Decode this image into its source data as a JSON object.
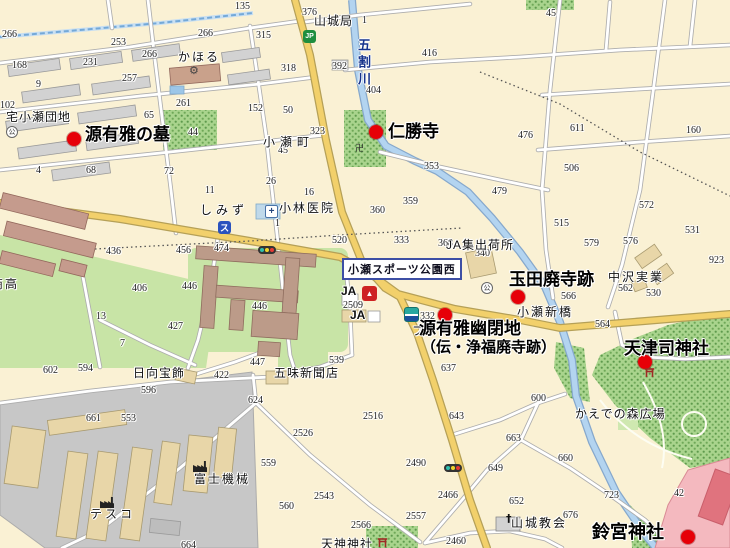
{
  "map": {
    "sign": {
      "text": "小瀬スポーツ公園西"
    },
    "river": {
      "name": "五割川"
    },
    "colors": {
      "marker_red": "#E60008",
      "major_road": "#F2D06B",
      "river_blue": "#B3D4F0",
      "forest_green": "#A9D48D",
      "field_green": "#C8E4A6",
      "industrial_gray": "#C7C7C7"
    },
    "pois": [
      {
        "t": "源有雅の墓",
        "x": 85,
        "y": 126,
        "size": 17,
        "mx": 74,
        "my": 139
      },
      {
        "t": "仁勝寺",
        "x": 388,
        "y": 123,
        "size": 17,
        "mx": 376,
        "my": 132
      },
      {
        "t": "玉田廃寺跡",
        "x": 509,
        "y": 271,
        "size": 17,
        "mx": 518,
        "my": 297
      },
      {
        "t": "源有雅幽閉地",
        "x": 419,
        "y": 320,
        "size": 17,
        "mx": 445,
        "my": 315,
        "line2": {
          "t": "（伝・浄福廃寺跡）",
          "x": 421,
          "y": 340,
          "size": 15
        }
      },
      {
        "t": "天津司神社",
        "x": 624,
        "y": 340,
        "size": 17,
        "mx": 645,
        "my": 362
      },
      {
        "t": "鈴宮神社",
        "x": 592,
        "y": 523,
        "size": 18,
        "mx": 688,
        "my": 537
      }
    ],
    "places": [
      {
        "x": 178,
        "y": 51,
        "t": "かほる",
        "ls": 2
      },
      {
        "x": 6,
        "y": 111,
        "t": "宅小瀬団地",
        "ls": 1
      },
      {
        "x": 314,
        "y": 15,
        "t": "山城局",
        "ls": 1
      },
      {
        "x": 263,
        "y": 136,
        "t": "小瀬町",
        "ls": 5
      },
      {
        "x": 200,
        "y": 204,
        "t": "しみず",
        "ls": 4
      },
      {
        "x": 279,
        "y": 202,
        "t": "小林医院",
        "ls": 2
      },
      {
        "x": 446,
        "y": 239,
        "t": "JA集出荷所",
        "ls": 1
      },
      {
        "x": 608,
        "y": 271,
        "t": "中沢実業",
        "ls": 2
      },
      {
        "x": 517,
        "y": 306,
        "t": "小瀬新橋",
        "ls": 2
      },
      {
        "x": 341,
        "y": 285,
        "t": "JA",
        "b": 1
      },
      {
        "x": 350,
        "y": 309,
        "t": "JA",
        "b": 1
      },
      {
        "x": 133,
        "y": 367,
        "t": "日向宝飾",
        "ls": 1
      },
      {
        "x": 274,
        "y": 367,
        "t": "五味新聞店",
        "ls": 1
      },
      {
        "x": 194,
        "y": 473,
        "t": "富士機械",
        "ls": 2
      },
      {
        "x": 90,
        "y": 508,
        "t": "テスコ",
        "ls": 3
      },
      {
        "x": 511,
        "y": 517,
        "t": "山城教会",
        "ls": 2
      },
      {
        "x": 575,
        "y": 408,
        "t": "かえでの森広場",
        "ls": 1
      },
      {
        "x": 321,
        "y": 538,
        "t": "天神神社",
        "ls": 1
      },
      {
        "x": -9,
        "y": 278,
        "t": "商高",
        "ls": 2
      },
      {
        "x": 412,
        "y": 325,
        "t": "フ"
      }
    ],
    "numbers": [
      {
        "x": 235,
        "y": 2,
        "t": "135"
      },
      {
        "x": 2,
        "y": 30,
        "t": "266"
      },
      {
        "x": 111,
        "y": 38,
        "t": "253"
      },
      {
        "x": 142,
        "y": 50,
        "t": "266"
      },
      {
        "x": 198,
        "y": 29,
        "t": "266"
      },
      {
        "x": 83,
        "y": 58,
        "t": "231"
      },
      {
        "x": 122,
        "y": 74,
        "t": "257"
      },
      {
        "x": 12,
        "y": 61,
        "t": "168"
      },
      {
        "x": 36,
        "y": 80,
        "t": "9"
      },
      {
        "x": 0,
        "y": 101,
        "t": "102"
      },
      {
        "x": 176,
        "y": 99,
        "t": "261"
      },
      {
        "x": 144,
        "y": 111,
        "t": "65"
      },
      {
        "x": 188,
        "y": 128,
        "t": "44"
      },
      {
        "x": 86,
        "y": 166,
        "t": "68"
      },
      {
        "x": 164,
        "y": 167,
        "t": "72"
      },
      {
        "x": 36,
        "y": 166,
        "t": "4"
      },
      {
        "x": 205,
        "y": 186,
        "t": "11"
      },
      {
        "x": 256,
        "y": 31,
        "t": "315"
      },
      {
        "x": 281,
        "y": 64,
        "t": "318"
      },
      {
        "x": 332,
        "y": 62,
        "t": "392"
      },
      {
        "x": 422,
        "y": 49,
        "t": "416"
      },
      {
        "x": 366,
        "y": 86,
        "t": "404"
      },
      {
        "x": 248,
        "y": 104,
        "t": "152"
      },
      {
        "x": 283,
        "y": 106,
        "t": "50"
      },
      {
        "x": 310,
        "y": 127,
        "t": "323"
      },
      {
        "x": 278,
        "y": 146,
        "t": "45"
      },
      {
        "x": 266,
        "y": 177,
        "t": "26"
      },
      {
        "x": 424,
        "y": 162,
        "t": "353"
      },
      {
        "x": 304,
        "y": 188,
        "t": "16"
      },
      {
        "x": 302,
        "y": 8,
        "t": "376"
      },
      {
        "x": 362,
        "y": 16,
        "t": "1"
      },
      {
        "x": 546,
        "y": 9,
        "t": "45"
      },
      {
        "x": 518,
        "y": 131,
        "t": "476"
      },
      {
        "x": 570,
        "y": 124,
        "t": "611"
      },
      {
        "x": 686,
        "y": 126,
        "t": "160"
      },
      {
        "x": 564,
        "y": 164,
        "t": "506"
      },
      {
        "x": 492,
        "y": 187,
        "t": "479"
      },
      {
        "x": 106,
        "y": 247,
        "t": "436"
      },
      {
        "x": 176,
        "y": 246,
        "t": "456"
      },
      {
        "x": 214,
        "y": 244,
        "t": "474"
      },
      {
        "x": 132,
        "y": 284,
        "t": "406"
      },
      {
        "x": 182,
        "y": 282,
        "t": "446"
      },
      {
        "x": 96,
        "y": 312,
        "t": "13"
      },
      {
        "x": 168,
        "y": 322,
        "t": "427"
      },
      {
        "x": 120,
        "y": 339,
        "t": "7"
      },
      {
        "x": 403,
        "y": 197,
        "t": "359"
      },
      {
        "x": 370,
        "y": 206,
        "t": "360"
      },
      {
        "x": 394,
        "y": 236,
        "t": "333"
      },
      {
        "x": 332,
        "y": 236,
        "t": "520"
      },
      {
        "x": 252,
        "y": 302,
        "t": "446"
      },
      {
        "x": 343,
        "y": 301,
        "t": "2509"
      },
      {
        "x": 275,
        "y": 219,
        "t": "1"
      },
      {
        "x": 639,
        "y": 201,
        "t": "572"
      },
      {
        "x": 685,
        "y": 226,
        "t": "531"
      },
      {
        "x": 554,
        "y": 219,
        "t": "515"
      },
      {
        "x": 584,
        "y": 239,
        "t": "579"
      },
      {
        "x": 623,
        "y": 237,
        "t": "576"
      },
      {
        "x": 438,
        "y": 239,
        "t": "368"
      },
      {
        "x": 475,
        "y": 249,
        "t": "340"
      },
      {
        "x": 709,
        "y": 256,
        "t": "923"
      },
      {
        "x": 618,
        "y": 284,
        "t": "562"
      },
      {
        "x": 646,
        "y": 289,
        "t": "530"
      },
      {
        "x": 561,
        "y": 292,
        "t": "566"
      },
      {
        "x": 595,
        "y": 320,
        "t": "564"
      },
      {
        "x": 420,
        "y": 312,
        "t": "332"
      },
      {
        "x": 43,
        "y": 366,
        "t": "602"
      },
      {
        "x": 78,
        "y": 364,
        "t": "594"
      },
      {
        "x": 141,
        "y": 386,
        "t": "596"
      },
      {
        "x": 214,
        "y": 371,
        "t": "422"
      },
      {
        "x": 86,
        "y": 414,
        "t": "661"
      },
      {
        "x": 121,
        "y": 414,
        "t": "553"
      },
      {
        "x": 181,
        "y": 541,
        "t": "664"
      },
      {
        "x": 250,
        "y": 358,
        "t": "447"
      },
      {
        "x": 329,
        "y": 356,
        "t": "539"
      },
      {
        "x": 441,
        "y": 364,
        "t": "637"
      },
      {
        "x": 248,
        "y": 396,
        "t": "624"
      },
      {
        "x": 363,
        "y": 412,
        "t": "2516"
      },
      {
        "x": 293,
        "y": 429,
        "t": "2526"
      },
      {
        "x": 449,
        "y": 412,
        "t": "643"
      },
      {
        "x": 261,
        "y": 459,
        "t": "559"
      },
      {
        "x": 406,
        "y": 459,
        "t": "2490"
      },
      {
        "x": 314,
        "y": 492,
        "t": "2543"
      },
      {
        "x": 279,
        "y": 502,
        "t": "560"
      },
      {
        "x": 438,
        "y": 491,
        "t": "2466"
      },
      {
        "x": 406,
        "y": 512,
        "t": "2557"
      },
      {
        "x": 351,
        "y": 521,
        "t": "2566"
      },
      {
        "x": 446,
        "y": 537,
        "t": "2460"
      },
      {
        "x": 531,
        "y": 394,
        "t": "600"
      },
      {
        "x": 506,
        "y": 434,
        "t": "663"
      },
      {
        "x": 558,
        "y": 454,
        "t": "660"
      },
      {
        "x": 488,
        "y": 464,
        "t": "649"
      },
      {
        "x": 509,
        "y": 497,
        "t": "652"
      },
      {
        "x": 563,
        "y": 511,
        "t": "676"
      },
      {
        "x": 604,
        "y": 491,
        "t": "723"
      },
      {
        "x": 674,
        "y": 489,
        "t": "42"
      }
    ],
    "icons": [
      {
        "x": 303,
        "y": 30,
        "type": "jp",
        "glyph": "JP",
        "name": "jp-post-bank-icon"
      },
      {
        "x": 218,
        "y": 221,
        "type": "su",
        "glyph": "ス",
        "name": "shop-su-icon"
      },
      {
        "x": 265,
        "y": 205,
        "type": "med",
        "glyph": "+",
        "name": "clinic-icon"
      },
      {
        "x": 258,
        "y": 246,
        "type": "signal",
        "name": "traffic-signal-icon"
      },
      {
        "x": 444,
        "y": 464,
        "type": "signal",
        "name": "traffic-signal-icon"
      },
      {
        "x": 362,
        "y": 286,
        "type": "ja",
        "glyph": "▲",
        "name": "ja-store-icon"
      },
      {
        "x": 404,
        "y": 307,
        "type": "bank",
        "name": "bank-store-icon"
      },
      {
        "x": 6,
        "y": 126,
        "type": "kou",
        "glyph": "公",
        "name": "community-center-icon"
      },
      {
        "x": 481,
        "y": 282,
        "type": "kou",
        "glyph": "公",
        "name": "community-center-icon"
      },
      {
        "x": 189,
        "y": 64,
        "type": "gear",
        "glyph": "⚙",
        "name": "factory-gear-icon"
      },
      {
        "x": 193,
        "y": 460,
        "type": "factory",
        "name": "factory-icon"
      },
      {
        "x": 100,
        "y": 496,
        "type": "factory",
        "name": "factory-icon"
      },
      {
        "x": 506,
        "y": 512,
        "type": "church",
        "glyph": "†",
        "name": "church-cross-icon"
      },
      {
        "x": 377,
        "y": 537,
        "type": "torii",
        "name": "torii-icon"
      },
      {
        "x": 644,
        "y": 367,
        "type": "torii",
        "name": "torii-icon"
      },
      {
        "x": 355,
        "y": 141,
        "type": "manji",
        "glyph": "卍",
        "name": "temple-manji-icon"
      }
    ]
  }
}
